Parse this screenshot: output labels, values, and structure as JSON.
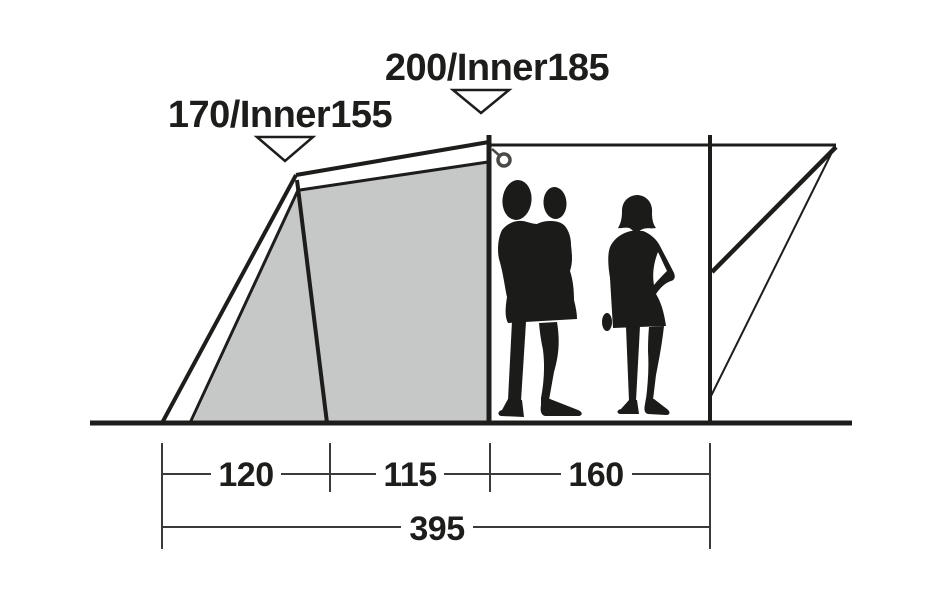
{
  "diagram": {
    "name": "tent-side-profile-dimension-diagram",
    "height_labels": {
      "left": "170/Inner155",
      "center": "200/Inner185"
    },
    "dimensions": {
      "segments": [
        {
          "value": "120"
        },
        {
          "value": "115"
        },
        {
          "value": "160"
        }
      ],
      "total": {
        "value": "395"
      }
    },
    "icons": {
      "left_height_marker": "triangle-down-icon",
      "center_height_marker": "triangle-down-icon",
      "guy_point": "ring-icon"
    },
    "colors": {
      "background": "#ffffff",
      "outline": "#1d1d1b",
      "panel_fill": "#c6c8c7",
      "dimension_line": "#3a3a38",
      "silhouette": "#1b1b19"
    }
  }
}
